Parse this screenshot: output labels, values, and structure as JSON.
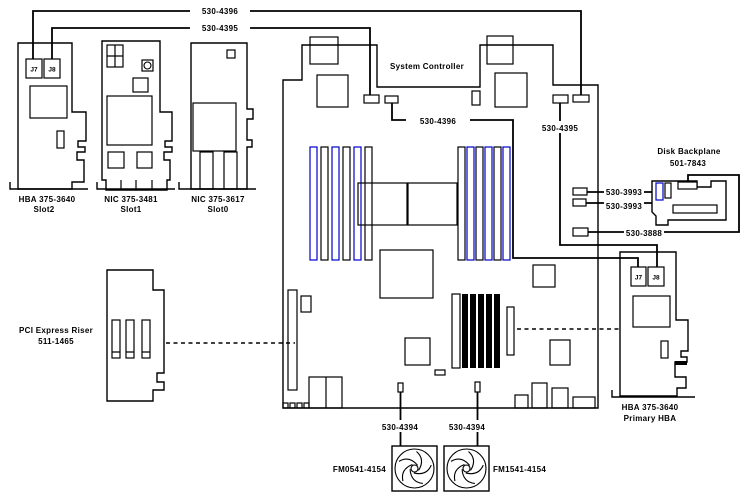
{
  "cards": {
    "hba_slot2": {
      "title": "HBA 375-3640",
      "subtitle": "Slot2",
      "j7": "J7",
      "j8": "J8"
    },
    "nic_slot1": {
      "title": "NIC 375-3481",
      "subtitle": "Slot1"
    },
    "nic_slot0": {
      "title": "NIC 375-3617",
      "subtitle": "Slot0"
    },
    "pci_riser": {
      "title": "PCI Express Riser",
      "subtitle": "511-1465"
    },
    "primary_hba": {
      "title": "HBA 375-3640",
      "subtitle": "Primary HBA",
      "j7": "J7",
      "j8": "J8"
    }
  },
  "motherboard": {
    "label": "System Controller"
  },
  "disk_backplane": {
    "title": "Disk Backplane",
    "subtitle": "501-7843"
  },
  "fans": [
    {
      "label": "FM0541-4154"
    },
    {
      "label": "FM1541-4154"
    }
  ],
  "cable_labels": {
    "top_a": "530-4396",
    "top_b": "530-4395",
    "mid_a": "530-4396",
    "mid_b": "530-4395",
    "backplane_a": "530-3993",
    "backplane_b": "530-3993",
    "backplane_c": "530-3888",
    "fan_a": "530-4394",
    "fan_b": "530-4394"
  },
  "colors": {
    "line": "#000000",
    "memory_slot_accent": "#0000cc",
    "background": "#ffffff"
  }
}
